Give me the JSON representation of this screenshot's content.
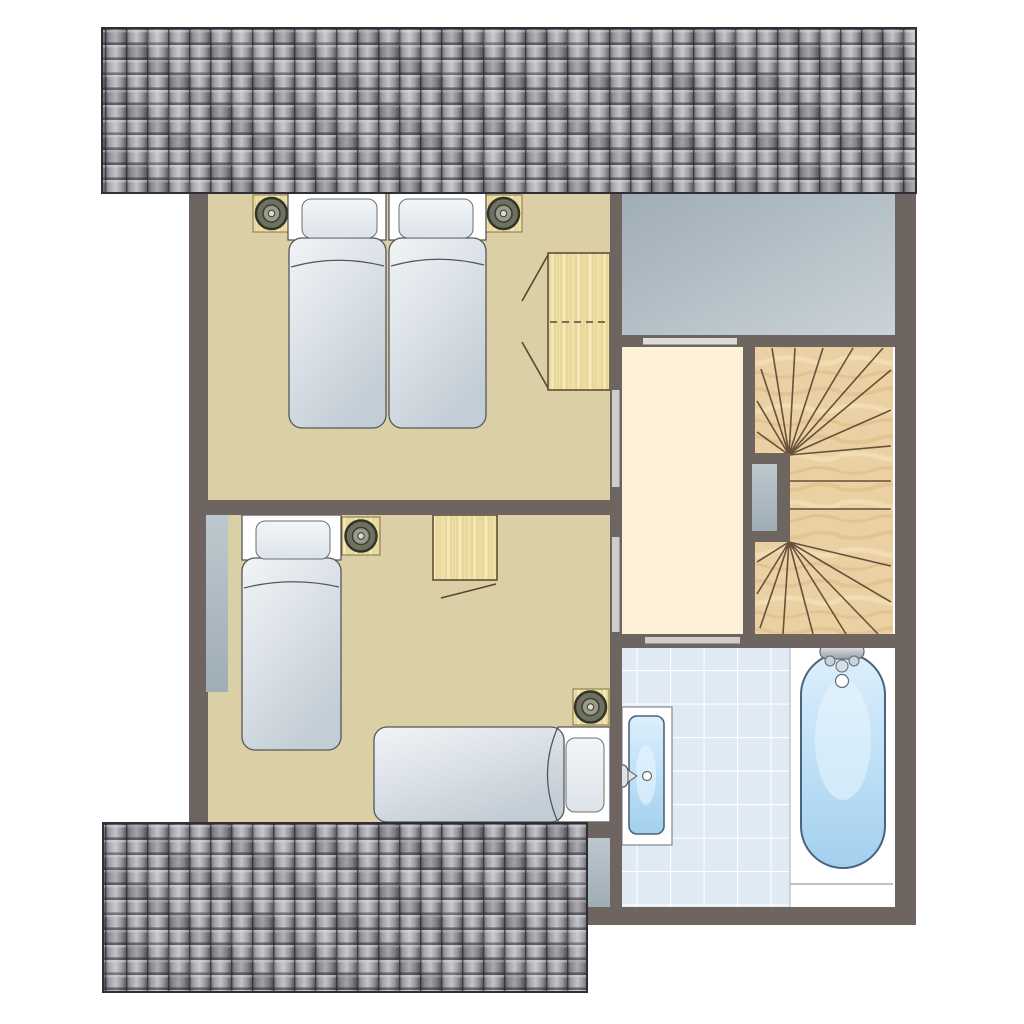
{
  "diagram": {
    "kind_label": "Upper floor plan",
    "rooms": [
      {
        "id": "bedroom-1",
        "furniture": [
          "twin-bed",
          "twin-bed",
          "nightstand-with-lamp",
          "nightstand-with-lamp",
          "wardrobe"
        ]
      },
      {
        "id": "bedroom-2",
        "furniture": [
          "single-bed-vertical",
          "single-bed-horizontal",
          "nightstand-with-lamp",
          "nightstand-with-lamp",
          "cabinet"
        ]
      },
      {
        "id": "landing-hall",
        "features": [
          "door-opening-bedroom-1",
          "door-opening-bedroom-2",
          "door-opening-bathroom"
        ]
      },
      {
        "id": "staircase",
        "features": [
          "winder-stairs",
          "central-newel-wall"
        ]
      },
      {
        "id": "bathroom",
        "furniture": [
          "bathtub",
          "washbasin"
        ],
        "features": [
          "tiled-floor"
        ]
      },
      {
        "id": "void-area",
        "features": []
      }
    ],
    "roofs": [
      "roof-top",
      "roof-bottom"
    ]
  },
  "palette": {
    "wall": "#6e6560",
    "bedroom_floor": "#dbcfa5",
    "hall_floor": "#fdf2d8",
    "stair_wood": "#ead0a2",
    "light_wood": "#eee1a7",
    "bath_tile": "#e0eaf4",
    "water_fixture": "#bfe0f6",
    "void_area": "#aab7c0",
    "roof_tile": "#95959b",
    "door_opening": "#cdcdcd",
    "window_glass": "#aeb9c0"
  }
}
